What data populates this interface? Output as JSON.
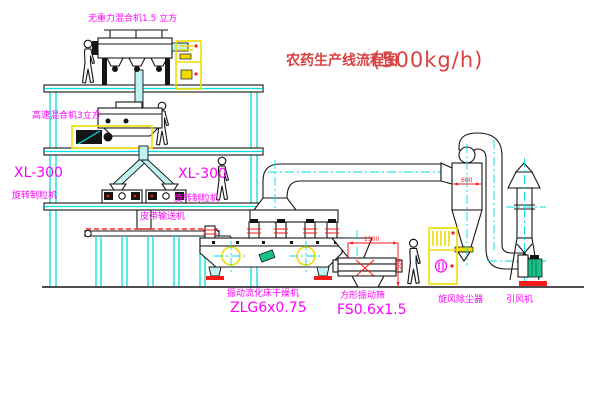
{
  "title": {
    "text": "农药生产线流程图",
    "capacity": "(500kg/h)"
  },
  "labels": {
    "gravity_mixer": "无重力混合机1.5 立方",
    "high_speed_mixer": "高速混合机3立方",
    "granulator_left_model": "XL-300",
    "granulator_left_name": "旋转制粒机",
    "granulator_center_model": "XL-300",
    "granulator_center_name": "旋转制粒机",
    "belt_conveyor": "皮带输送机",
    "dryer_name": "振动流化床干燥机",
    "dryer_model": "ZLG6x0.75",
    "sieve_name": "方形振动筛",
    "sieve_model": "FS0.6x1.5",
    "cyclone": "旋风除尘器",
    "fan": "引风机"
  },
  "dimensions": {
    "sieve_length": "1500",
    "sieve_height": "500",
    "cyclone_width": "600"
  },
  "colors": {
    "line_cyan": "#00DEDE",
    "label_magenta": "#FF00FF",
    "title_red": "#D94040",
    "dimension_red": "#FF1A1A",
    "equipment_yellow": "#F0DC00",
    "motor_green": "#19C08A",
    "line_black": "#151515"
  }
}
